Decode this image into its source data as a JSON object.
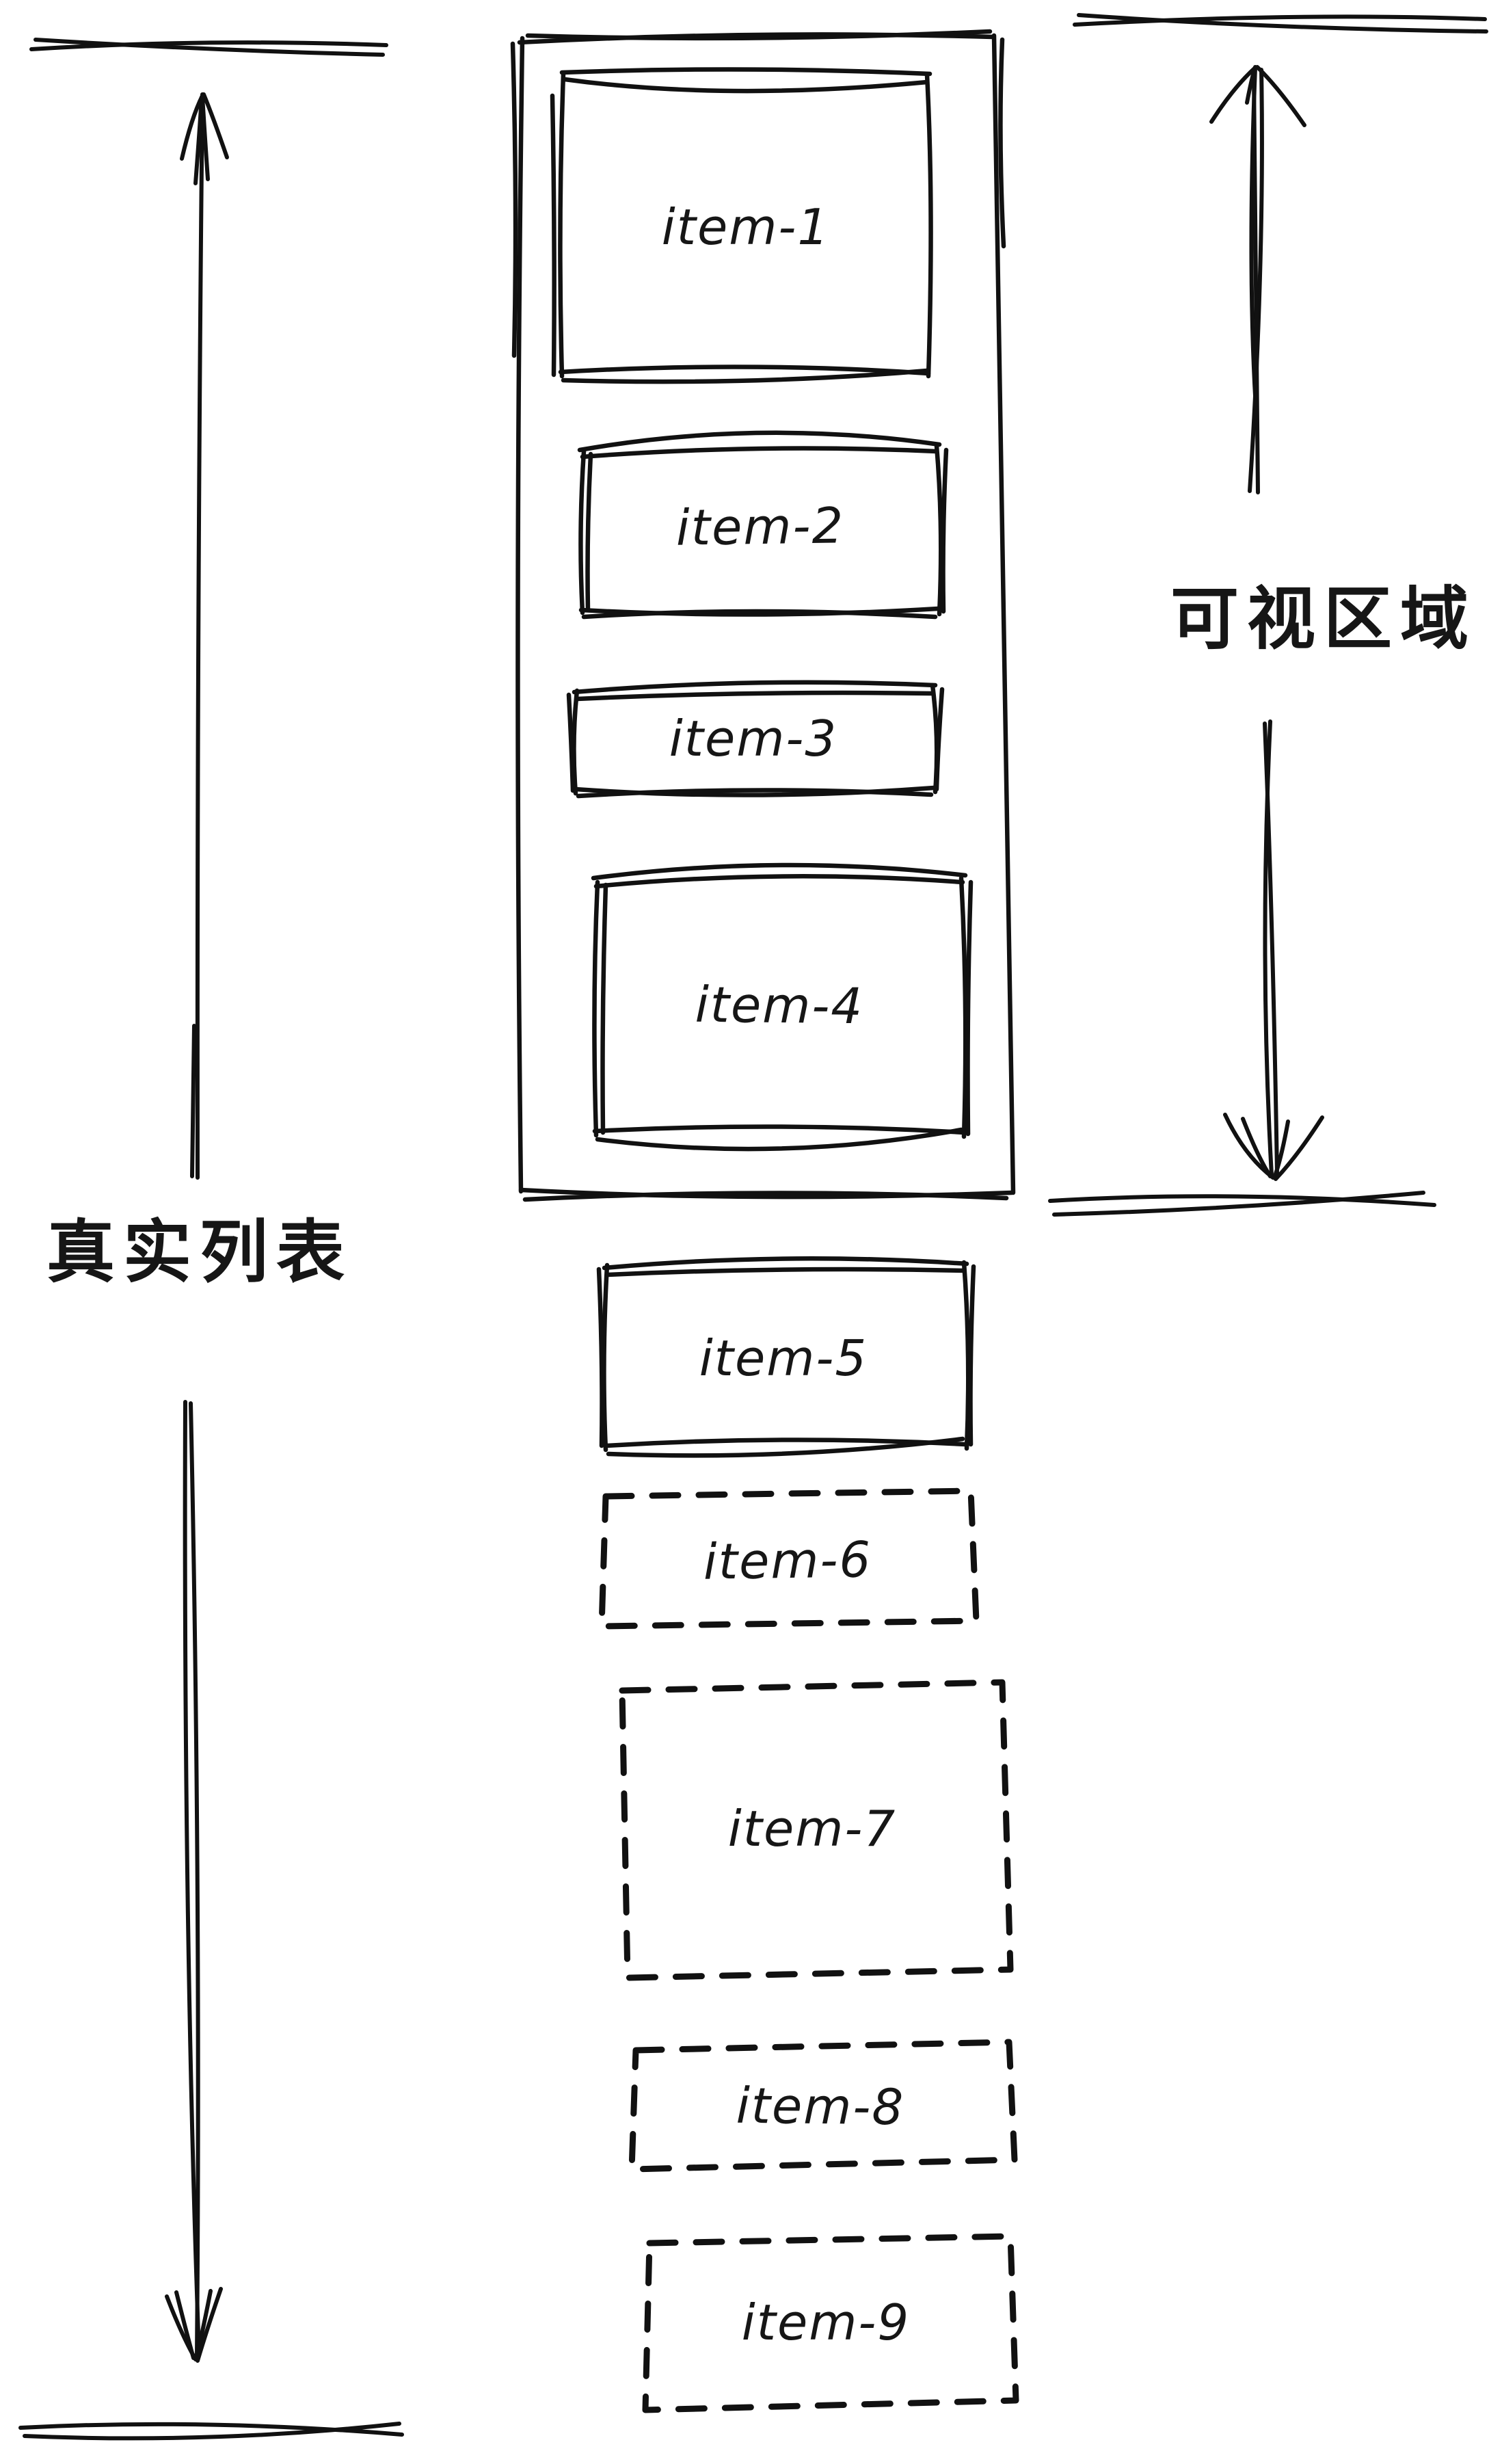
{
  "annotations": {
    "real_list_label": "真实列表",
    "visible_area_label": "可视区域"
  },
  "list_items": [
    {
      "label": "item-1",
      "line_style": "solid",
      "inside_viewport": true
    },
    {
      "label": "item-2",
      "line_style": "solid",
      "inside_viewport": true
    },
    {
      "label": "item-3",
      "line_style": "solid",
      "inside_viewport": true
    },
    {
      "label": "item-4",
      "line_style": "solid",
      "inside_viewport": true
    },
    {
      "label": "item-5",
      "line_style": "solid",
      "inside_viewport": false
    },
    {
      "label": "item-6",
      "line_style": "dashed",
      "inside_viewport": false
    },
    {
      "label": "item-7",
      "line_style": "dashed",
      "inside_viewport": false
    },
    {
      "label": "item-8",
      "line_style": "dashed",
      "inside_viewport": false
    },
    {
      "label": "item-9",
      "line_style": "dashed",
      "inside_viewport": false
    }
  ],
  "colors": {
    "ink": "#111111",
    "background": "#ffffff"
  }
}
